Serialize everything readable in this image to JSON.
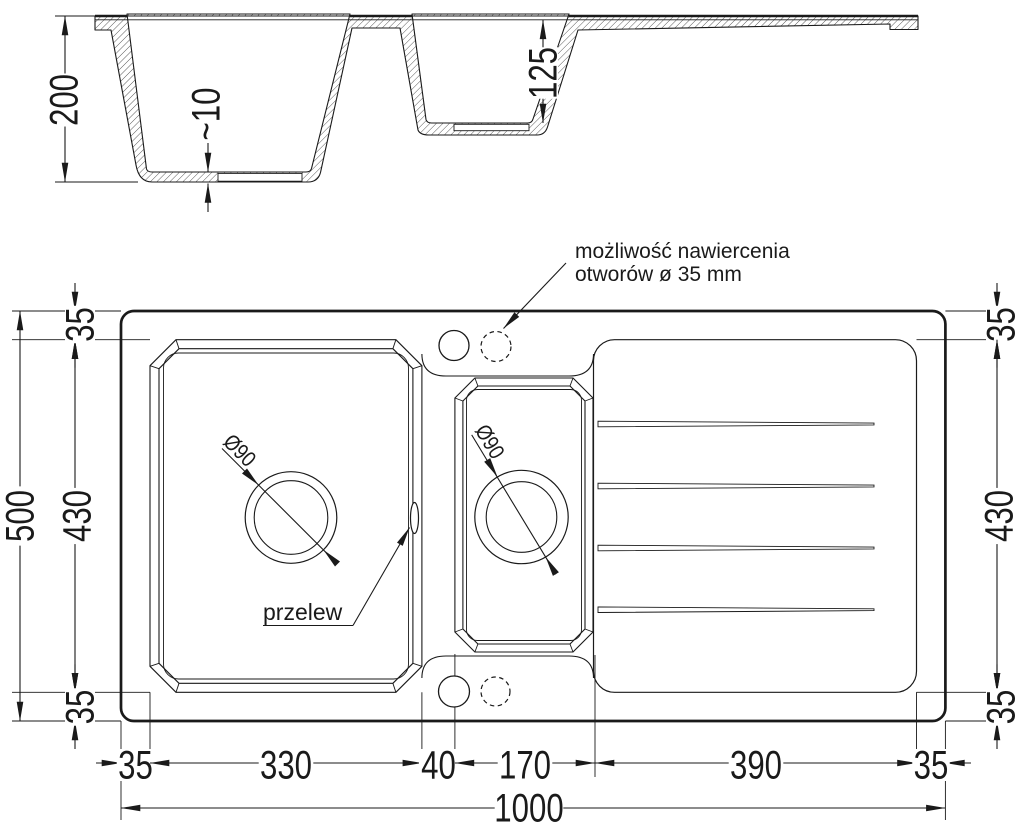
{
  "colors": {
    "ink": "#1a1a1a",
    "background": "#ffffff"
  },
  "note": {
    "line1": "możliwość nawiercenia",
    "line2": "otworów ø 35 mm"
  },
  "labels": {
    "overflow": "przelew",
    "drain_main": "Ø90",
    "drain_small": "Ø90"
  },
  "section": {
    "depth_total": "200",
    "floor_thickness": "~10",
    "depth_small": "125"
  },
  "plan": {
    "width_total": "1000",
    "height_total": "500",
    "height_inner_left": "430",
    "height_inner_right": "430",
    "offset_top_left": "35",
    "offset_bottom_left": "35",
    "offset_top_right": "35",
    "offset_bottom_right": "35",
    "bottom_segments": [
      "35",
      "330",
      "40",
      "170",
      "390",
      "35"
    ]
  }
}
